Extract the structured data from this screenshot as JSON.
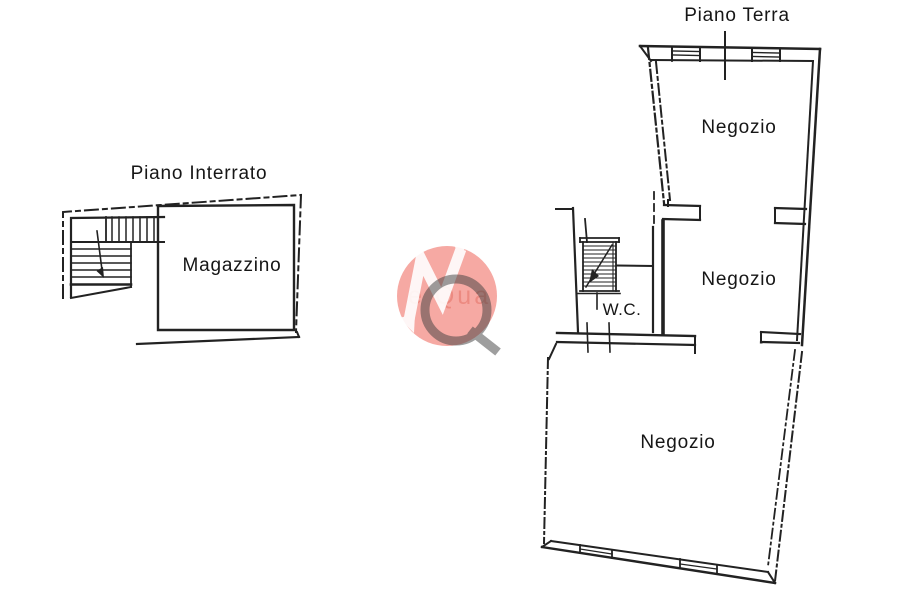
{
  "document": {
    "type": "floor-plan",
    "background": "#ffffff",
    "line_color": "#222222",
    "border_color": "#b3b3b3"
  },
  "plans": {
    "basement": {
      "title": "Piano Interrato",
      "rooms": [
        {
          "label": "Magazzino"
        }
      ],
      "features": [
        "staircase",
        "dashed-perimeter"
      ]
    },
    "ground": {
      "title": "Piano Terra",
      "rooms": [
        {
          "label": "Negozio"
        },
        {
          "label": "Negozio"
        },
        {
          "label": "Negozio"
        },
        {
          "label": "W.C."
        }
      ],
      "features": [
        "staircase",
        "windows",
        "door-openings"
      ]
    }
  },
  "watermark": {
    "text": "e Qua",
    "monogram": "MQ",
    "circle_color": "#ee5a4e",
    "m_color": "#ffffff",
    "q_color": "#3f3f3f"
  }
}
